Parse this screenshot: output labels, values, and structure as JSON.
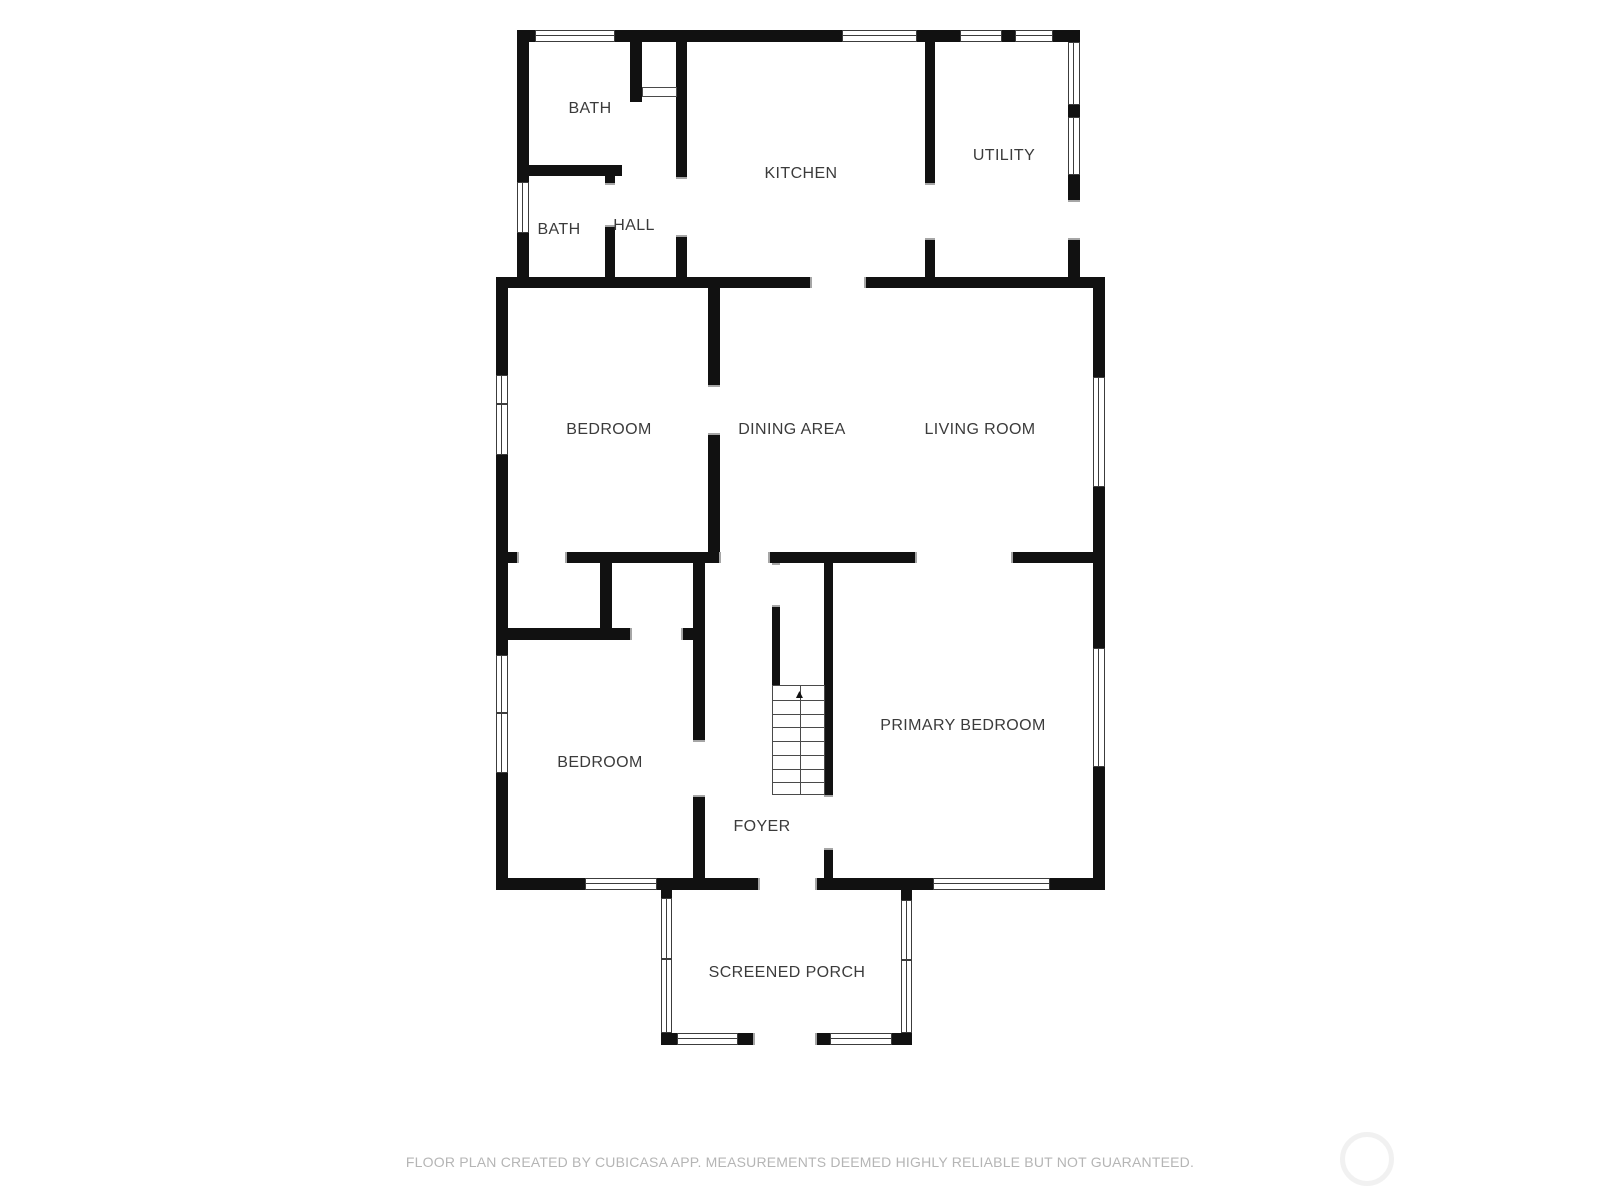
{
  "plan": {
    "colors": {
      "wall": "#111111",
      "window_frame": "#3c3c3c",
      "door_jamb": "#a6a6a6",
      "label_text": "#3b3b3b",
      "footer_text": "#b5b5b5",
      "watermark_ring": "#f1f1f1"
    },
    "rooms": [
      {
        "id": "bath-upper",
        "label": "BATH",
        "x": 590,
        "y": 109
      },
      {
        "id": "kitchen",
        "label": "KITCHEN",
        "x": 801,
        "y": 174
      },
      {
        "id": "utility",
        "label": "UTILITY",
        "x": 1004,
        "y": 156
      },
      {
        "id": "bath-lower",
        "label": "BATH",
        "x": 559,
        "y": 230
      },
      {
        "id": "hall",
        "label": "HALL",
        "x": 634,
        "y": 226
      },
      {
        "id": "bedroom-middle",
        "label": "BEDROOM",
        "x": 609,
        "y": 430
      },
      {
        "id": "dining-area",
        "label": "DINING AREA",
        "x": 792,
        "y": 430
      },
      {
        "id": "living-room",
        "label": "LIVING ROOM",
        "x": 980,
        "y": 430
      },
      {
        "id": "bedroom-lower",
        "label": "BEDROOM",
        "x": 600,
        "y": 763
      },
      {
        "id": "primary-bedroom",
        "label": "PRIMARY BEDROOM",
        "x": 963,
        "y": 726
      },
      {
        "id": "foyer",
        "label": "FOYER",
        "x": 762,
        "y": 827
      },
      {
        "id": "screened-porch",
        "label": "SCREENED PORCH",
        "x": 787,
        "y": 973
      }
    ],
    "walls": [
      [
        517,
        30,
        18,
        12
      ],
      [
        615,
        30,
        227,
        12
      ],
      [
        917,
        30,
        43,
        12
      ],
      [
        1002,
        30,
        13,
        12
      ],
      [
        1053,
        30,
        27,
        12
      ],
      [
        517,
        42,
        12,
        140
      ],
      [
        517,
        233,
        12,
        44
      ],
      [
        1068,
        105,
        12,
        12
      ],
      [
        1068,
        175,
        12,
        25
      ],
      [
        1068,
        240,
        12,
        37
      ],
      [
        630,
        42,
        12,
        60
      ],
      [
        517,
        165,
        105,
        11
      ],
      [
        605,
        165,
        10,
        18
      ],
      [
        605,
        227,
        10,
        61
      ],
      [
        676,
        42,
        11,
        135
      ],
      [
        676,
        237,
        11,
        51
      ],
      [
        925,
        42,
        10,
        141
      ],
      [
        925,
        240,
        10,
        48
      ],
      [
        496,
        277,
        314,
        11
      ],
      [
        866,
        277,
        239,
        11
      ],
      [
        496,
        288,
        12,
        87
      ],
      [
        496,
        455,
        12,
        97
      ],
      [
        1093,
        288,
        12,
        89
      ],
      [
        1093,
        487,
        12,
        65
      ],
      [
        708,
        288,
        12,
        97
      ],
      [
        708,
        435,
        12,
        117
      ],
      [
        496,
        552,
        21,
        11
      ],
      [
        567,
        552,
        152,
        11
      ],
      [
        770,
        552,
        145,
        11
      ],
      [
        1013,
        552,
        92,
        11
      ],
      [
        496,
        563,
        12,
        92
      ],
      [
        496,
        773,
        12,
        117
      ],
      [
        1093,
        563,
        12,
        85
      ],
      [
        1093,
        767,
        12,
        123
      ],
      [
        600,
        563,
        12,
        77
      ],
      [
        505,
        628,
        125,
        12
      ],
      [
        683,
        628,
        22,
        12
      ],
      [
        693,
        563,
        12,
        177
      ],
      [
        693,
        797,
        12,
        93
      ],
      [
        772,
        607,
        8,
        78
      ],
      [
        824,
        563,
        9,
        232
      ],
      [
        824,
        850,
        9,
        28
      ],
      [
        496,
        878,
        89,
        12
      ],
      [
        657,
        878,
        101,
        12
      ],
      [
        817,
        878,
        116,
        12
      ],
      [
        1050,
        878,
        55,
        12
      ],
      [
        661,
        890,
        11,
        8
      ],
      [
        661,
        1033,
        16,
        12
      ],
      [
        901,
        890,
        11,
        10
      ],
      [
        892,
        1033,
        20,
        12
      ],
      [
        738,
        1033,
        15,
        12
      ],
      [
        817,
        1033,
        13,
        12
      ]
    ],
    "windows": [
      {
        "x": 535,
        "y": 30,
        "w": 80,
        "h": 12,
        "dir": "h",
        "ticks": []
      },
      {
        "x": 842,
        "y": 30,
        "w": 75,
        "h": 12,
        "dir": "h",
        "ticks": []
      },
      {
        "x": 960,
        "y": 30,
        "w": 42,
        "h": 12,
        "dir": "h",
        "ticks": []
      },
      {
        "x": 1015,
        "y": 30,
        "w": 38,
        "h": 12,
        "dir": "h",
        "ticks": []
      },
      {
        "x": 585,
        "y": 878,
        "w": 72,
        "h": 12,
        "dir": "h",
        "ticks": []
      },
      {
        "x": 933,
        "y": 878,
        "w": 117,
        "h": 12,
        "dir": "h",
        "ticks": []
      },
      {
        "x": 677,
        "y": 1033,
        "w": 61,
        "h": 12,
        "dir": "h",
        "ticks": []
      },
      {
        "x": 830,
        "y": 1033,
        "w": 62,
        "h": 12,
        "dir": "h",
        "ticks": []
      },
      {
        "x": 517,
        "y": 182,
        "w": 12,
        "h": 51,
        "dir": "v",
        "ticks": []
      },
      {
        "x": 1068,
        "y": 42,
        "w": 12,
        "h": 63,
        "dir": "v",
        "ticks": []
      },
      {
        "x": 1068,
        "y": 117,
        "w": 12,
        "h": 58,
        "dir": "v",
        "ticks": []
      },
      {
        "x": 496,
        "y": 375,
        "w": 12,
        "h": 80,
        "dir": "v",
        "ticks": [
          0.35
        ]
      },
      {
        "x": 1093,
        "y": 377,
        "w": 12,
        "h": 110,
        "dir": "v",
        "ticks": []
      },
      {
        "x": 496,
        "y": 655,
        "w": 12,
        "h": 118,
        "dir": "v",
        "ticks": [
          0.48
        ]
      },
      {
        "x": 1093,
        "y": 648,
        "w": 12,
        "h": 119,
        "dir": "v",
        "ticks": []
      },
      {
        "x": 661,
        "y": 898,
        "w": 11,
        "h": 135,
        "dir": "v",
        "ticks": [
          0.44
        ]
      },
      {
        "x": 901,
        "y": 900,
        "w": 11,
        "h": 133,
        "dir": "v",
        "ticks": [
          0.44
        ]
      }
    ],
    "doors": [
      {
        "id": "utility-exterior-door",
        "x": 1068,
        "y": 200,
        "w": 12,
        "h": 40,
        "dir": "v"
      },
      {
        "id": "bath-hall-door",
        "x": 605,
        "y": 183,
        "w": 10,
        "h": 44,
        "dir": "v"
      },
      {
        "id": "hall-kitchen-door",
        "x": 676,
        "y": 177,
        "w": 11,
        "h": 60,
        "dir": "v"
      },
      {
        "id": "kitchen-utility-door",
        "x": 925,
        "y": 183,
        "w": 10,
        "h": 57,
        "dir": "v"
      },
      {
        "id": "bedroom-dining-opening",
        "x": 708,
        "y": 385,
        "w": 12,
        "h": 50,
        "dir": "v"
      },
      {
        "id": "bedroom-foyer-door",
        "x": 693,
        "y": 740,
        "w": 12,
        "h": 57,
        "dir": "v"
      },
      {
        "id": "stair-top-door",
        "x": 772,
        "y": 563,
        "w": 8,
        "h": 44,
        "dir": "v"
      },
      {
        "id": "foyer-primary-door",
        "x": 824,
        "y": 795,
        "w": 9,
        "h": 55,
        "dir": "v"
      },
      {
        "id": "kitchen-dining-opening",
        "x": 810,
        "y": 277,
        "w": 56,
        "h": 11,
        "dir": "h"
      },
      {
        "id": "closet-a-door",
        "x": 517,
        "y": 552,
        "w": 50,
        "h": 11,
        "dir": "h"
      },
      {
        "id": "dining-foyer-opening",
        "x": 719,
        "y": 552,
        "w": 51,
        "h": 11,
        "dir": "h"
      },
      {
        "id": "living-primary-opening",
        "x": 915,
        "y": 552,
        "w": 98,
        "h": 11,
        "dir": "h"
      },
      {
        "id": "closet-b-door",
        "x": 630,
        "y": 628,
        "w": 53,
        "h": 12,
        "dir": "h"
      },
      {
        "id": "foyer-porch-door",
        "x": 758,
        "y": 878,
        "w": 59,
        "h": 12,
        "dir": "h"
      },
      {
        "id": "porch-exit-opening",
        "x": 753,
        "y": 1033,
        "w": 64,
        "h": 12,
        "dir": "h"
      }
    ],
    "door_leaf": {
      "x": 642,
      "y": 87,
      "w": 35,
      "h": 10
    },
    "stairs": {
      "x": 772,
      "y": 685,
      "w": 53,
      "h": 110,
      "treads": 8,
      "arrow_glyph": "▲"
    }
  },
  "footer": {
    "text": "FLOOR PLAN CREATED BY CUBICASA APP. MEASUREMENTS DEEMED HIGHLY RELIABLE BUT NOT GUARANTEED."
  },
  "watermark": {
    "cx": 1367,
    "cy": 1159,
    "r": 27
  }
}
